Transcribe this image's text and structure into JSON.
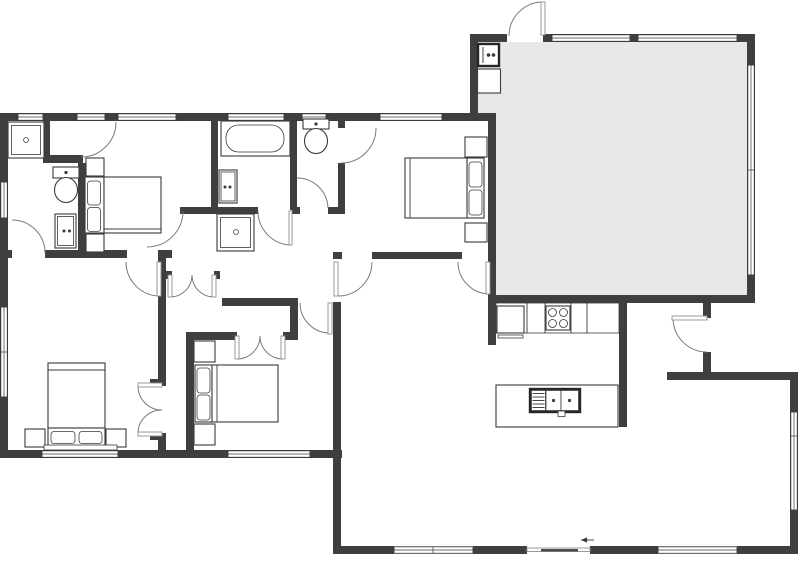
{
  "app": {
    "name": "residential-floor-plan"
  },
  "colors": {
    "wall": "#3f3f42",
    "line": "#3a3a3a",
    "arc": "#7a7a7a",
    "leaf": "#8f8f8f",
    "garage": "#e8e8e8",
    "floor": "#ffffff"
  },
  "inventory": {
    "rooms": [
      "garage",
      "bedroom-1",
      "bedroom-2",
      "bedroom-3",
      "bedroom-4",
      "bathroom-1",
      "bathroom-2",
      "wc-closet",
      "hallway",
      "kitchen",
      "living-dining",
      "closet-1",
      "closet-2",
      "entry-porch"
    ],
    "fixtures": [
      "shower-1",
      "toilet-1",
      "vanity-1",
      "bathtub",
      "vanity-2",
      "shower-2",
      "toilet-2",
      "bed-1",
      "bed-2",
      "bed-3",
      "bed-4",
      "water-heater",
      "utility-box",
      "refrigerator",
      "cooktop-4-burner",
      "kitchen-counter",
      "kitchen-island",
      "island-double-sink",
      "sliding-patio-door"
    ],
    "door_count": 16,
    "window_count": 13
  }
}
